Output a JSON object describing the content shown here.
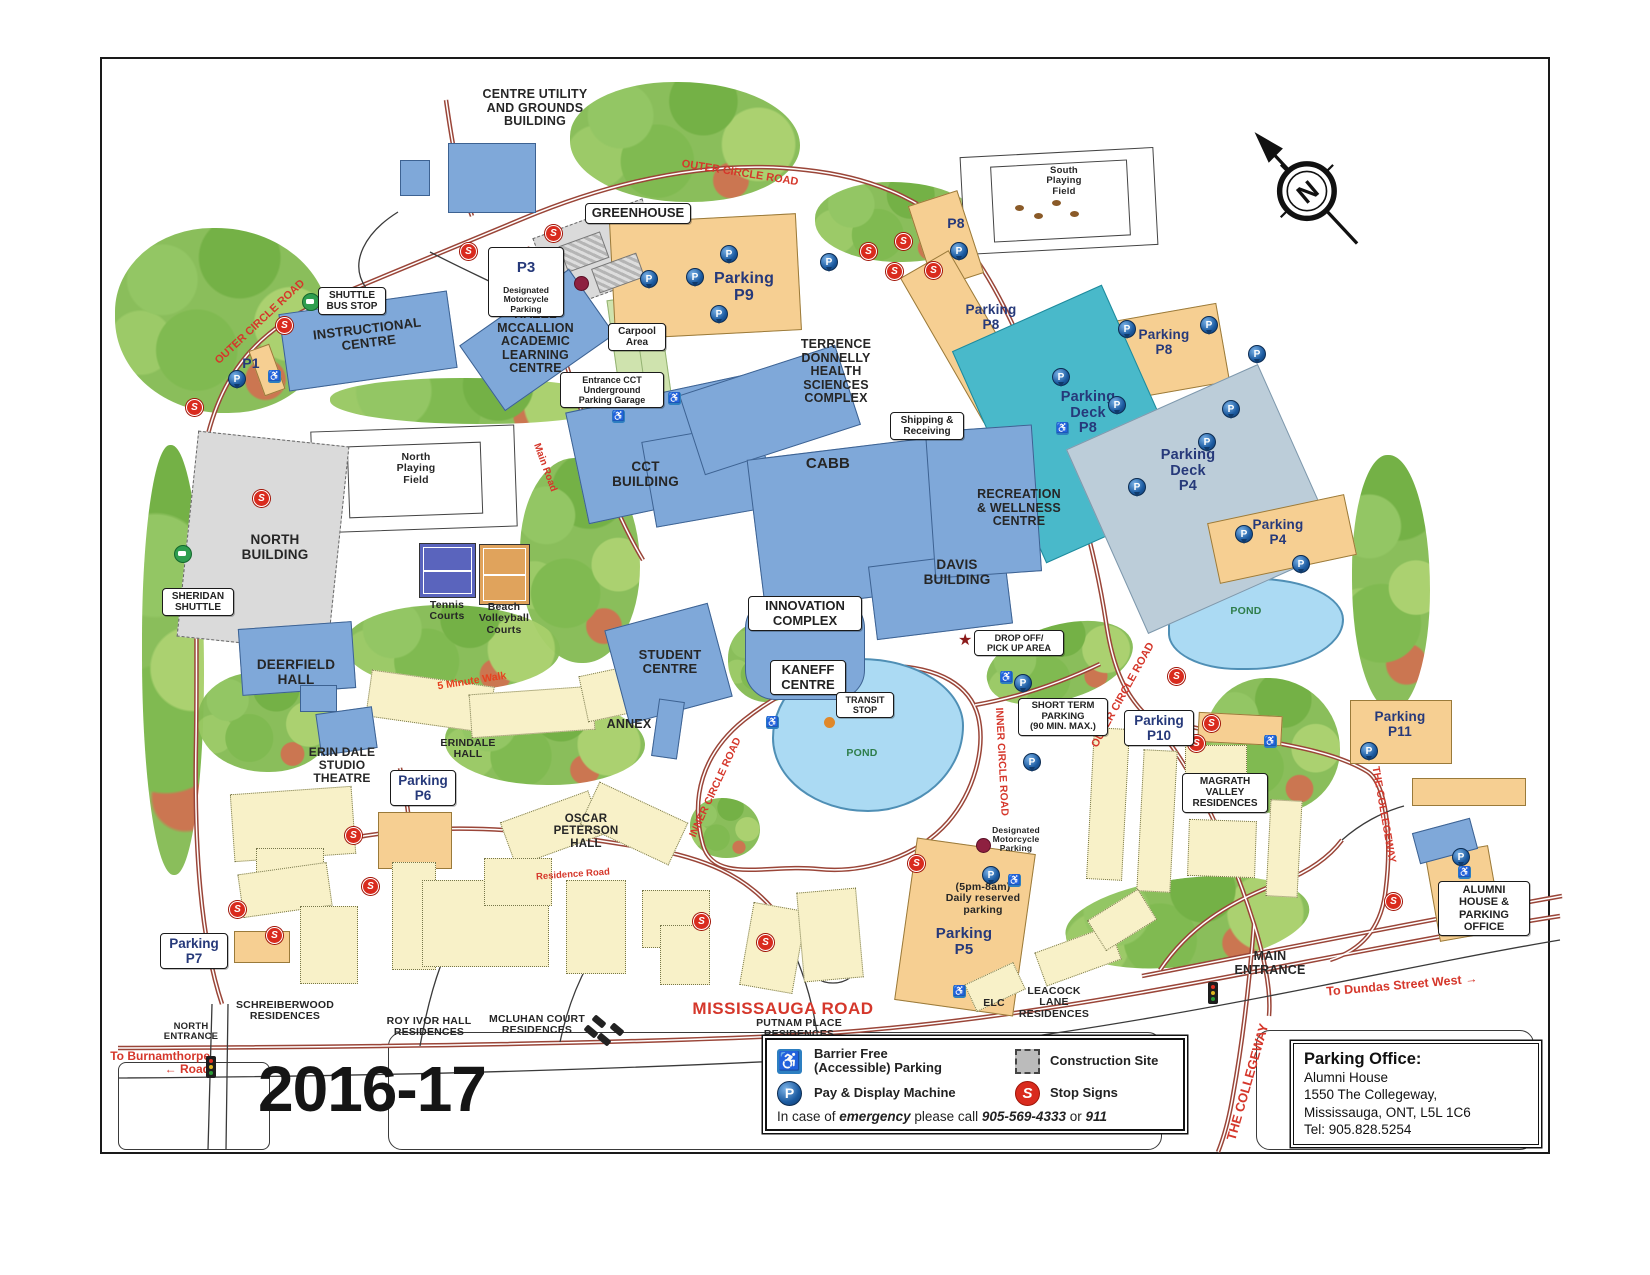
{
  "title_year": "2016-17",
  "icons": {
    "p": "P",
    "s": "S",
    "n": "N",
    "star": "★",
    "wheelchair": "♿"
  },
  "buildings": {
    "centre_utility": "CENTRE UTILITY\nAND GROUNDS\nBUILDING",
    "instructional": "INSTRUCTIONAL\nCENTRE",
    "hazel": "HAZEL\nMCCALLION\nACADEMIC\nLEARNING\nCENTRE",
    "cct": "CCT\nBUILDING",
    "donnelly": "TERRENCE\nDONNELLY\nHEALTH\nSCIENCES\nCOMPLEX",
    "cabb": "CABB",
    "recreation": "RECREATION\n& WELLNESS\nCENTRE",
    "davis": "DAVIS\nBUILDING",
    "innovation": "INNOVATION\nCOMPLEX",
    "kaneff": "KANEFF\nCENTRE",
    "student": "STUDENT\nCENTRE",
    "north_building": "NORTH\nBUILDING",
    "deerfield": "DEERFIELD\nHALL",
    "erindale_studio": "ERIN DALE\nSTUDIO\nTHEATRE",
    "erindale_hall": "ERINDALE\nHALL",
    "oscar": "OSCAR\nPETERSON\nHALL",
    "annex": "ANNEX",
    "greenhouse": "GREENHOUSE",
    "alumni": "ALUMNI\nHOUSE &\nPARKING\nOFFICE",
    "magrath": "MAGRATH\nVALLEY\nRESIDENCES",
    "schreiberwood": "SCHREIBERWOOD\nRESIDENCES",
    "roy_ivor": "ROY IVOR HALL\nRESIDENCES",
    "mcluhan": "MCLUHAN COURT\nRESIDENCES",
    "putnam": "PUTNAM PLACE\nRESIDENCES",
    "elc": "ELC",
    "leacock": "LEACOCK\nLANE\nRESIDENCES"
  },
  "parking": {
    "p1": "P1",
    "p3_title": "P3",
    "p3_sub": "Designated\nMotorcycle\nParking",
    "p4": "Parking\nP4",
    "p5": "Parking\nP5",
    "p5_reserved": "(5pm-8am)\nDaily reserved\nparking",
    "p5_moto": "Designated\nMotorcycle\nParking",
    "p6": "Parking\nP6",
    "p7": "Parking\nP7",
    "p8_small": "P8",
    "p8_mid": "Parking\nP8",
    "p8_east": "Parking\nP8",
    "p9": "Parking\nP9",
    "p10": "Parking\nP10",
    "p11": "Parking\nP11",
    "deck_p8": "Parking\nDeck\nP8",
    "deck_p4": "Parking\nDeck\nP4",
    "short_term": "SHORT TERM\nPARKING\n(90 MIN. MAX.)",
    "cct_garage": "Entrance CCT\nUnderground\nParking Garage"
  },
  "places": {
    "shuttle_bus_stop": "SHUTTLE\nBUS STOP",
    "sheridan_shuttle": "SHERIDAN\nSHUTTLE",
    "carpool": "Carpool\nArea",
    "shipping": "Shipping &\nReceiving",
    "drop_off": "DROP OFF/\nPICK UP AREA",
    "transit_stop": "TRANSIT\nSTOP",
    "main_entrance": "MAIN\nENTRANCE",
    "north_entrance": "NORTH\nENTRANCE",
    "north_field": "North\nPlaying\nField",
    "south_field": "South\nPlaying\nField",
    "tennis": "Tennis\nCourts",
    "beach": "Beach\nVolleyball\nCourts",
    "pond": "POND",
    "five_minute_walk": "5 Minute Walk"
  },
  "roads": {
    "outer": "OUTER CIRCLE ROAD",
    "inner": "INNER CIRCLE ROAD",
    "main_road": "Main Road",
    "mississauga": "MISSISSAUGA ROAD",
    "residence": "Residence Road",
    "collegeway": "THE COLLEGEWAY",
    "to_dundas": "To Dundas Street West  →",
    "to_burnamthorpe": "To Burnamthorpe\n← Road"
  },
  "legend": {
    "barrier": "Barrier Free\n(Accessible) Parking",
    "construction": "Construction Site",
    "pay": "Pay & Display Machine",
    "stop": "Stop Signs",
    "em_pre": "In case of ",
    "em_word": "emergency",
    "em_mid": " please call ",
    "em_phone": "905-569-4333",
    "em_or": " or ",
    "em_911": "911"
  },
  "office": {
    "title": "Parking Office:",
    "line1": "Alumni House",
    "line2": "1550 The Collegeway,",
    "line3": "Mississauga, ONT, L5L 1C6",
    "line4": "Tel: 905.828.5254"
  },
  "colors": {
    "building_blue": "#7FA8D9",
    "construction_gray": "#DADADA",
    "parking_orange": "#F6CF92",
    "deck_teal": "#49B9CA",
    "deck_gray": "#BCCDD9",
    "residence_cream": "#F8F1C8",
    "pond_blue": "#ABDAF3",
    "road_label_red": "#D5372B",
    "parking_label_navy": "#26397A",
    "stop_sign_red": "#D92B1E",
    "pay_display_blue": "#1B5AA0",
    "accessible_blue": "#2D7FC1",
    "shuttle_green": "#2F9E4F"
  }
}
